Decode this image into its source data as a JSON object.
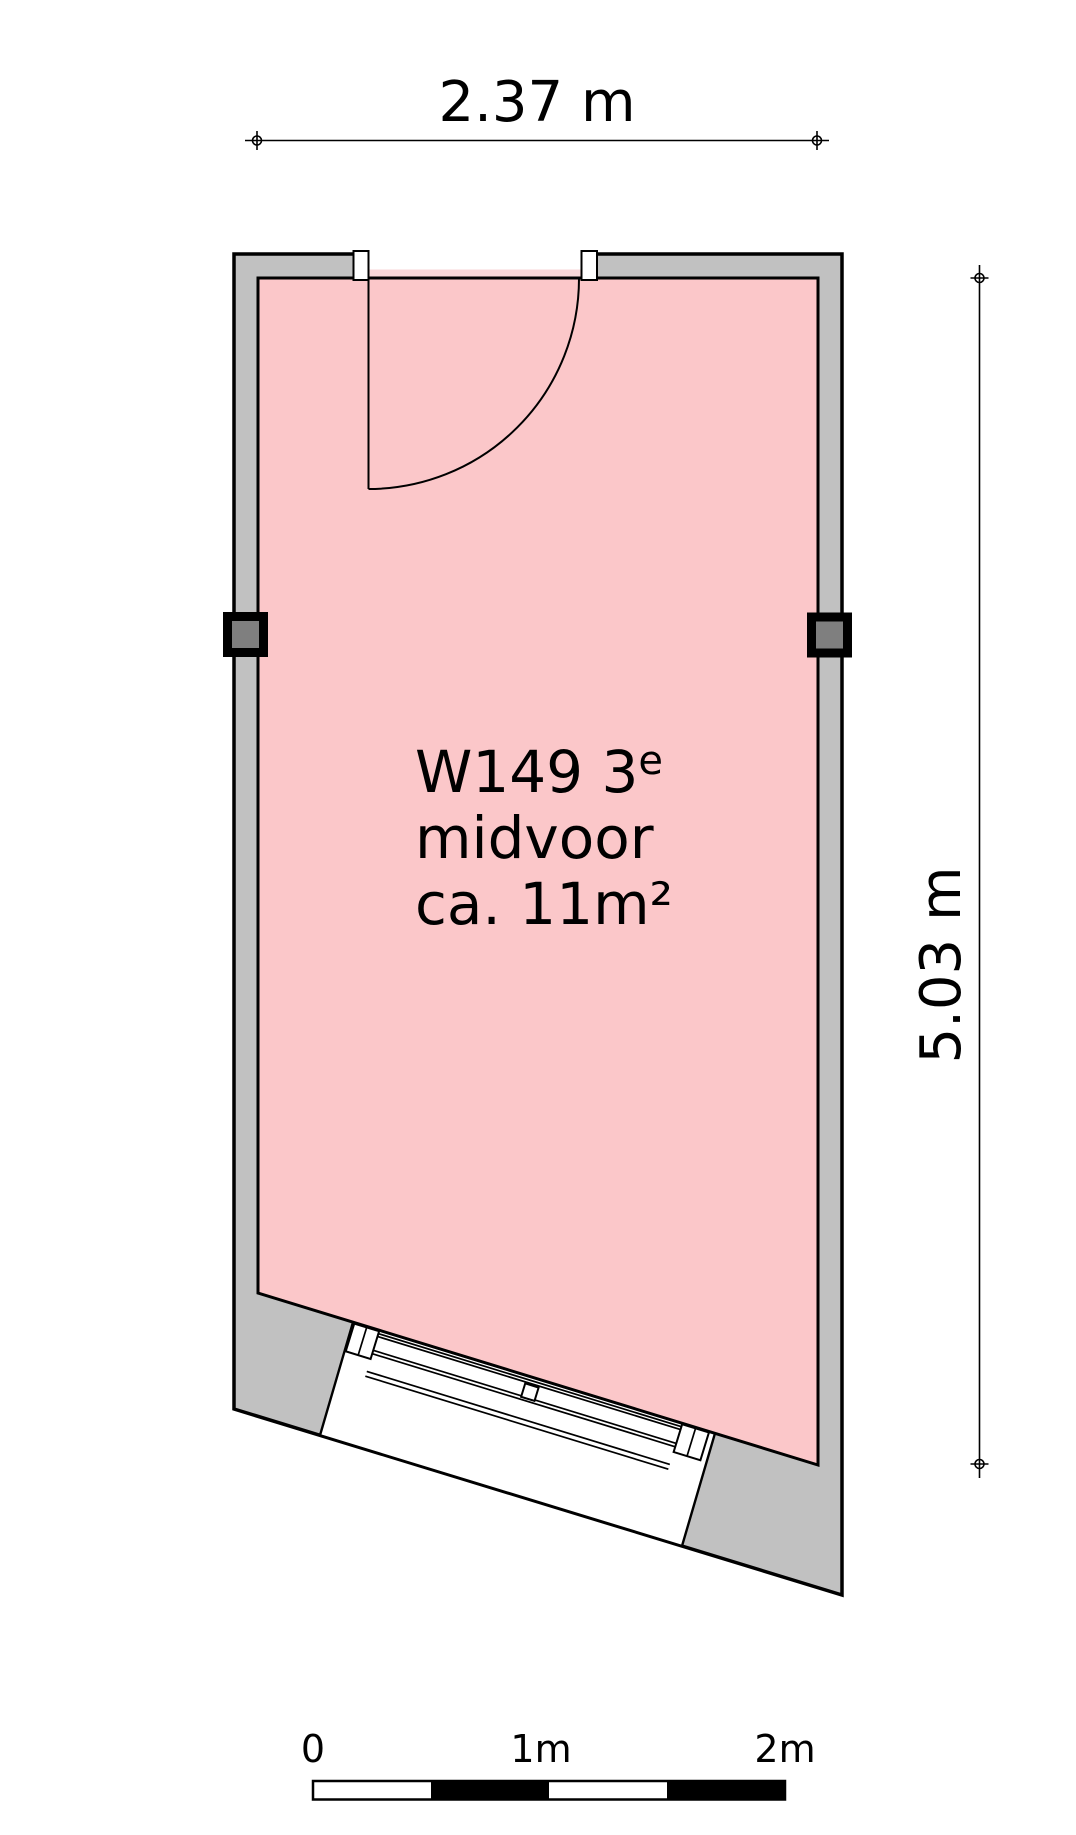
{
  "room": {
    "name_line1": "W149 3",
    "name_superscript": "e",
    "name_line2": "midvoor",
    "area_line": "ca. 11m²"
  },
  "dimensions": {
    "width_label": "2.37 m",
    "height_label": "5.03 m"
  },
  "scale_bar": {
    "tick0": "0",
    "tick1": "1m",
    "tick2": "2m"
  },
  "colors": {
    "room_fill": "#FBC7C9",
    "threshold_fill": "#F8D7D8",
    "wall_fill": "#C1C1C1",
    "column_fill": "#7F7F7F",
    "outline": "#000000"
  }
}
